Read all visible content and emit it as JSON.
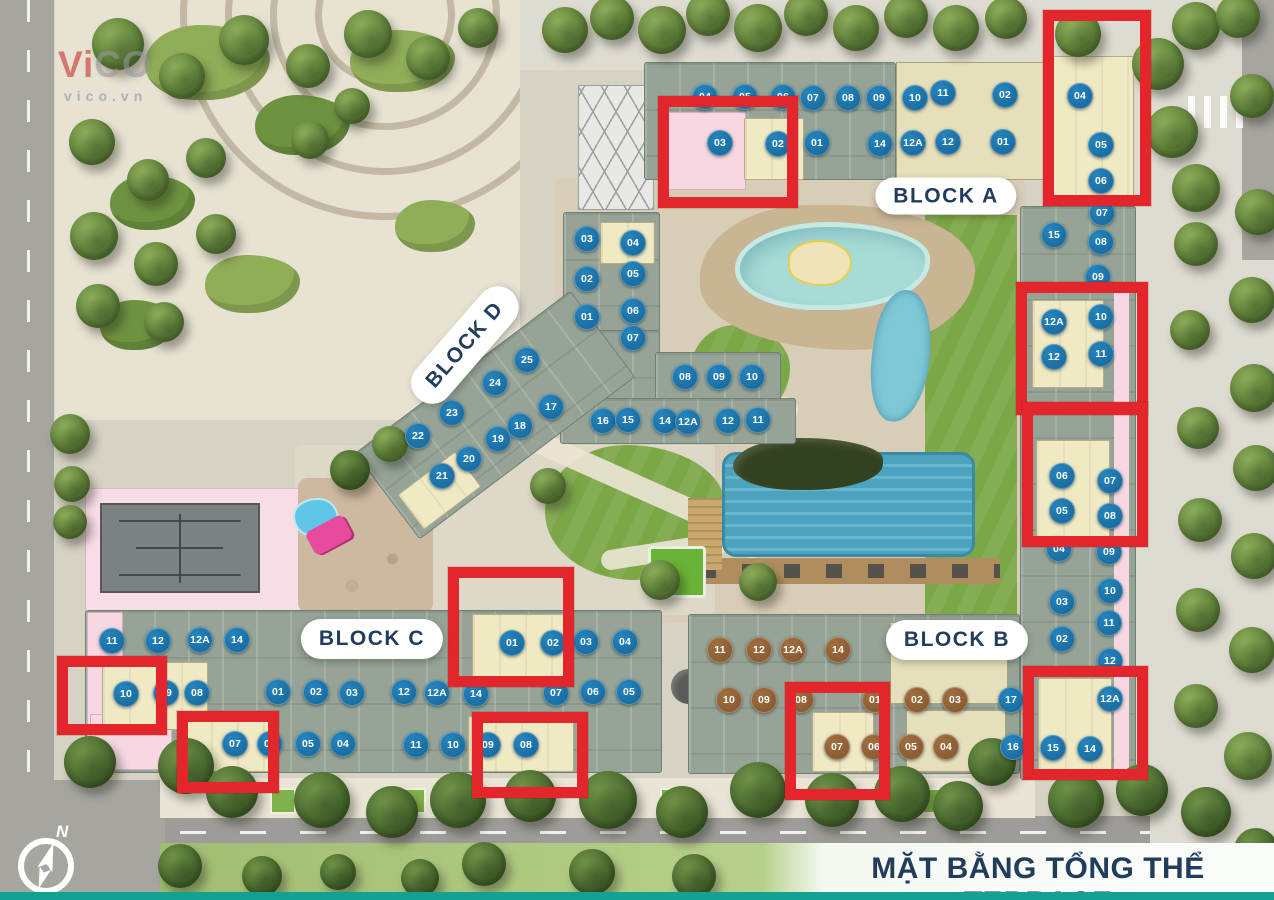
{
  "title": {
    "text": "MẶT BẰNG TỔNG THỂ TERRACE"
  },
  "watermark": {
    "part_red": "Vi",
    "part_gray": "CO",
    "domain_text": "vico.vn"
  },
  "compass": {
    "north_label": "N"
  },
  "colors": {
    "unit_blue": "#1a6da1",
    "unit_blue_hi": "#2585bd",
    "unit_brown": "#8a5c34",
    "unit_brown_hi": "#a06f3e",
    "highlight_red": "#e2262c",
    "title_navy": "#223d5c",
    "footer_teal": "#12a192"
  },
  "block_labels": [
    {
      "id": "block-a",
      "label": "BLOCK A",
      "x": 946,
      "y": 196,
      "h": 37,
      "rotate": 0
    },
    {
      "id": "block-b",
      "label": "BLOCK B",
      "x": 957,
      "y": 640,
      "h": 40,
      "rotate": 0
    },
    {
      "id": "block-c",
      "label": "BLOCK C",
      "x": 372,
      "y": 639,
      "h": 40,
      "rotate": 0
    },
    {
      "id": "block-d",
      "label": "BLOCK D",
      "x": 465,
      "y": 345,
      "h": 42,
      "rotate": -49
    }
  ],
  "red_boxes": [
    {
      "x": 1043,
      "y": 10,
      "w": 108,
      "h": 196
    },
    {
      "x": 658,
      "y": 96,
      "w": 140,
      "h": 112
    },
    {
      "x": 1016,
      "y": 282,
      "w": 132,
      "h": 133
    },
    {
      "x": 1022,
      "y": 402,
      "w": 126,
      "h": 145
    },
    {
      "x": 1023,
      "y": 666,
      "w": 125,
      "h": 114
    },
    {
      "x": 448,
      "y": 567,
      "w": 126,
      "h": 120
    },
    {
      "x": 57,
      "y": 656,
      "w": 110,
      "h": 79
    },
    {
      "x": 177,
      "y": 711,
      "w": 102,
      "h": 82
    },
    {
      "x": 472,
      "y": 712,
      "w": 116,
      "h": 86
    },
    {
      "x": 785,
      "y": 682,
      "w": 105,
      "h": 118
    }
  ],
  "unit_groups": [
    {
      "name": "block-a-top-row1",
      "color": "b",
      "units": [
        [
          "04",
          705,
          97
        ],
        [
          "05",
          745,
          97
        ],
        [
          "06",
          783,
          97
        ],
        [
          "07",
          813,
          98
        ],
        [
          "08",
          848,
          98
        ],
        [
          "09",
          879,
          98
        ],
        [
          "10",
          915,
          98
        ],
        [
          "11",
          943,
          93
        ],
        [
          "02",
          1005,
          95
        ]
      ]
    },
    {
      "name": "block-a-top-row2",
      "color": "b",
      "units": [
        [
          "03",
          720,
          143
        ],
        [
          "02",
          778,
          144
        ],
        [
          "01",
          817,
          143
        ],
        [
          "14",
          880,
          144
        ],
        [
          "12A",
          913,
          143
        ],
        [
          "12",
          948,
          142
        ],
        [
          "01",
          1003,
          142
        ]
      ]
    },
    {
      "name": "block-a-northeast",
      "color": "b",
      "units": [
        [
          "04",
          1080,
          96
        ],
        [
          "05",
          1101,
          145
        ],
        [
          "06",
          1101,
          181
        ]
      ]
    },
    {
      "name": "east-wing-upper",
      "color": "b",
      "units": [
        [
          "07",
          1102,
          213
        ],
        [
          "15",
          1054,
          235
        ],
        [
          "08",
          1101,
          242
        ],
        [
          "09",
          1098,
          277
        ]
      ]
    },
    {
      "name": "east-wing-highlight-upper",
      "color": "b",
      "units": [
        [
          "12A",
          1054,
          322
        ],
        [
          "10",
          1101,
          317
        ],
        [
          "12",
          1054,
          357
        ],
        [
          "11",
          1101,
          354
        ]
      ]
    },
    {
      "name": "east-wing-highlight-mid",
      "color": "b",
      "units": [
        [
          "06",
          1062,
          476
        ],
        [
          "07",
          1110,
          481
        ],
        [
          "05",
          1062,
          511
        ],
        [
          "08",
          1110,
          516
        ]
      ]
    },
    {
      "name": "east-wing-lower",
      "color": "b",
      "units": [
        [
          "04",
          1059,
          549
        ],
        [
          "09",
          1109,
          552
        ],
        [
          "10",
          1110,
          591
        ],
        [
          "03",
          1062,
          602
        ],
        [
          "11",
          1109,
          623
        ],
        [
          "02",
          1062,
          639
        ],
        [
          "12",
          1110,
          661
        ]
      ]
    },
    {
      "name": "east-wing-highlight-bottom",
      "color": "b",
      "units": [
        [
          "12A",
          1110,
          699
        ],
        [
          "15",
          1053,
          748
        ],
        [
          "14",
          1090,
          749
        ]
      ]
    },
    {
      "name": "center-building",
      "color": "b",
      "units": [
        [
          "03",
          587,
          239
        ],
        [
          "04",
          633,
          243
        ],
        [
          "05",
          633,
          274
        ],
        [
          "02",
          587,
          279
        ],
        [
          "06",
          633,
          311
        ],
        [
          "01",
          587,
          317
        ],
        [
          "07",
          633,
          338
        ],
        [
          "08",
          685,
          377
        ],
        [
          "09",
          719,
          377
        ],
        [
          "10",
          752,
          377
        ],
        [
          "16",
          603,
          421
        ],
        [
          "15",
          628,
          420
        ],
        [
          "14",
          665,
          421
        ],
        [
          "12A",
          688,
          422
        ],
        [
          "12",
          728,
          421
        ],
        [
          "11",
          758,
          420
        ]
      ]
    },
    {
      "name": "block-d",
      "color": "b",
      "units": [
        [
          "25",
          527,
          360
        ],
        [
          "24",
          495,
          383
        ],
        [
          "23",
          452,
          413
        ],
        [
          "22",
          418,
          436
        ],
        [
          "17",
          551,
          407
        ],
        [
          "18",
          520,
          426
        ],
        [
          "19",
          498,
          439
        ],
        [
          "20",
          469,
          459
        ],
        [
          "21",
          442,
          476
        ]
      ]
    },
    {
      "name": "block-c-row1",
      "color": "b",
      "units": [
        [
          "11",
          112,
          641
        ],
        [
          "12",
          158,
          641
        ],
        [
          "12A",
          200,
          640
        ],
        [
          "14",
          237,
          640
        ],
        [
          "01",
          512,
          643
        ],
        [
          "02",
          553,
          643
        ],
        [
          "03",
          586,
          642
        ],
        [
          "04",
          625,
          642
        ]
      ]
    },
    {
      "name": "block-c-row2",
      "color": "b",
      "units": [
        [
          "10",
          126,
          694
        ],
        [
          "09",
          166,
          693
        ],
        [
          "08",
          197,
          693
        ],
        [
          "01",
          278,
          692
        ],
        [
          "02",
          316,
          692
        ],
        [
          "03",
          352,
          693
        ],
        [
          "12",
          404,
          692
        ],
        [
          "12A",
          437,
          693
        ],
        [
          "14",
          476,
          694
        ],
        [
          "07",
          556,
          693
        ],
        [
          "06",
          593,
          692
        ],
        [
          "05",
          629,
          692
        ]
      ]
    },
    {
      "name": "block-c-row3",
      "color": "b",
      "units": [
        [
          "07",
          235,
          744
        ],
        [
          "06",
          270,
          744
        ],
        [
          "05",
          308,
          744
        ],
        [
          "04",
          343,
          744
        ],
        [
          "11",
          416,
          745
        ],
        [
          "10",
          453,
          745
        ],
        [
          "09",
          488,
          745
        ],
        [
          "08",
          526,
          745
        ]
      ]
    },
    {
      "name": "block-b-row1",
      "color": "br",
      "units": [
        [
          "11",
          720,
          650
        ],
        [
          "12",
          759,
          650
        ],
        [
          "12A",
          793,
          650
        ],
        [
          "14",
          838,
          650
        ]
      ]
    },
    {
      "name": "block-b-row2",
      "color": "br",
      "units": [
        [
          "10",
          729,
          700
        ],
        [
          "09",
          764,
          700
        ],
        [
          "08",
          801,
          700
        ],
        [
          "01",
          875,
          700
        ],
        [
          "02",
          917,
          700
        ],
        [
          "03",
          955,
          700
        ]
      ]
    },
    {
      "name": "block-b-row3",
      "color": "br",
      "units": [
        [
          "07",
          837,
          747
        ],
        [
          "06",
          874,
          747
        ],
        [
          "05",
          911,
          747
        ],
        [
          "04",
          946,
          747
        ]
      ]
    },
    {
      "name": "block-b-corner",
      "color": "b",
      "units": [
        [
          "17",
          1011,
          700
        ],
        [
          "16",
          1013,
          747
        ]
      ]
    }
  ],
  "decor": {
    "trees": [
      [
        565,
        30,
        46,
        0
      ],
      [
        612,
        18,
        44,
        0
      ],
      [
        662,
        30,
        48,
        0
      ],
      [
        708,
        14,
        44,
        0
      ],
      [
        758,
        28,
        48,
        0
      ],
      [
        806,
        14,
        44,
        0
      ],
      [
        856,
        28,
        46,
        0
      ],
      [
        906,
        16,
        44,
        0
      ],
      [
        956,
        28,
        46,
        0
      ],
      [
        1006,
        18,
        42,
        0
      ],
      [
        1078,
        34,
        46,
        0
      ],
      [
        1158,
        64,
        52,
        0
      ],
      [
        1196,
        26,
        48,
        0
      ],
      [
        1238,
        16,
        44,
        0
      ],
      [
        1172,
        132,
        52,
        0
      ],
      [
        1196,
        188,
        48,
        0
      ],
      [
        1252,
        96,
        44,
        0
      ],
      [
        1258,
        212,
        46,
        0
      ],
      [
        1196,
        244,
        44,
        0
      ],
      [
        1252,
        300,
        46,
        0
      ],
      [
        1190,
        330,
        40,
        0
      ],
      [
        1254,
        388,
        48,
        0
      ],
      [
        1198,
        428,
        42,
        0
      ],
      [
        1256,
        468,
        46,
        0
      ],
      [
        1200,
        520,
        44,
        0
      ],
      [
        1254,
        556,
        46,
        0
      ],
      [
        1198,
        610,
        44,
        0
      ],
      [
        1252,
        650,
        46,
        0
      ],
      [
        1196,
        706,
        44,
        0
      ],
      [
        1248,
        756,
        48,
        0
      ],
      [
        1206,
        812,
        50,
        1
      ],
      [
        1256,
        850,
        44,
        1
      ],
      [
        118,
        44,
        52,
        0
      ],
      [
        182,
        76,
        46,
        0
      ],
      [
        244,
        40,
        50,
        0
      ],
      [
        308,
        66,
        44,
        0
      ],
      [
        368,
        34,
        48,
        0
      ],
      [
        428,
        58,
        44,
        0
      ],
      [
        478,
        28,
        40,
        0
      ],
      [
        92,
        142,
        46,
        0
      ],
      [
        148,
        180,
        42,
        0
      ],
      [
        206,
        158,
        40,
        0
      ],
      [
        94,
        236,
        48,
        0
      ],
      [
        156,
        264,
        44,
        0
      ],
      [
        216,
        234,
        40,
        0
      ],
      [
        98,
        306,
        44,
        0
      ],
      [
        164,
        322,
        40,
        0
      ],
      [
        310,
        140,
        38,
        0
      ],
      [
        352,
        106,
        36,
        0
      ],
      [
        70,
        434,
        40,
        0
      ],
      [
        72,
        484,
        36,
        0
      ],
      [
        70,
        522,
        34,
        0
      ],
      [
        350,
        470,
        40,
        1
      ],
      [
        390,
        444,
        36,
        0
      ],
      [
        548,
        486,
        36,
        0
      ],
      [
        660,
        580,
        40,
        0
      ],
      [
        758,
        582,
        38,
        0
      ],
      [
        90,
        762,
        52,
        1
      ],
      [
        186,
        766,
        56,
        1
      ],
      [
        232,
        792,
        52,
        1
      ],
      [
        322,
        800,
        56,
        1
      ],
      [
        392,
        812,
        52,
        1
      ],
      [
        458,
        800,
        56,
        1
      ],
      [
        530,
        796,
        52,
        1
      ],
      [
        608,
        800,
        58,
        1
      ],
      [
        682,
        812,
        52,
        1
      ],
      [
        758,
        790,
        56,
        1
      ],
      [
        832,
        800,
        54,
        1
      ],
      [
        902,
        794,
        56,
        1
      ],
      [
        958,
        806,
        50,
        1
      ],
      [
        992,
        762,
        48,
        1
      ],
      [
        1076,
        800,
        56,
        1
      ],
      [
        1142,
        790,
        52,
        1
      ],
      [
        180,
        866,
        44,
        1
      ],
      [
        262,
        876,
        40,
        1
      ],
      [
        338,
        872,
        36,
        1
      ],
      [
        420,
        878,
        38,
        1
      ],
      [
        484,
        864,
        44,
        1
      ],
      [
        592,
        872,
        46,
        1
      ],
      [
        694,
        876,
        44,
        1
      ]
    ]
  }
}
